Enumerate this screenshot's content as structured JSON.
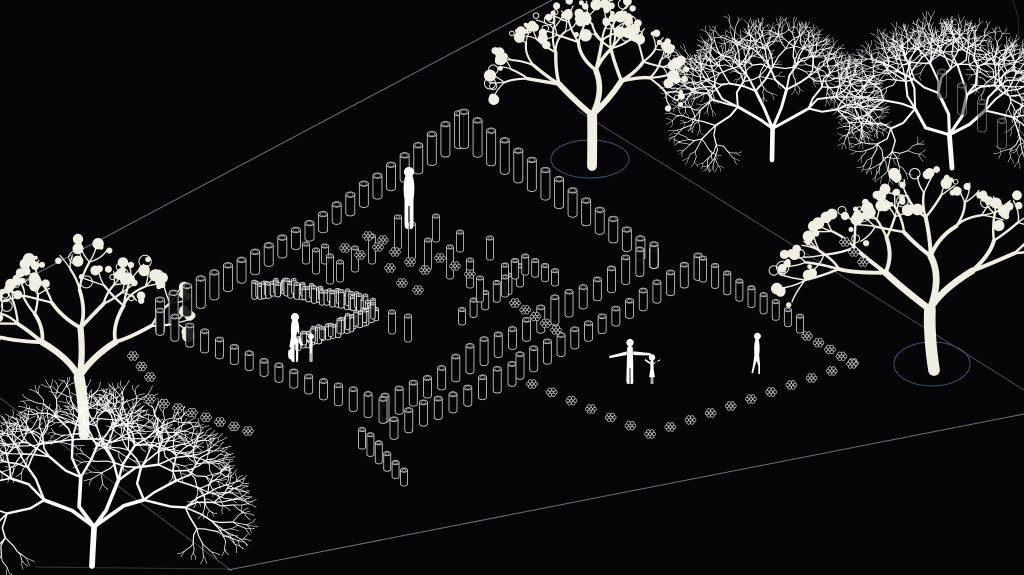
{
  "canvas": {
    "w": 1024,
    "h": 575,
    "background": "#050507"
  },
  "palette": {
    "line": "#9aa0b2",
    "post": "#c9c9cd",
    "post_bright": "#efefef",
    "hex": "#d6d6da",
    "person": "#ffffff",
    "fruit_tree": "#f0efe1",
    "bare_tree": "#fbfbfb",
    "pit": "#4a5580",
    "fill": "#050507"
  },
  "boundary_lines": [
    {
      "x1": 0,
      "y1": 293,
      "x2": 552,
      "y2": 0,
      "o": 0.7
    },
    {
      "x1": 577,
      "y1": 110,
      "x2": 1024,
      "y2": 390,
      "o": 0.45
    },
    {
      "x1": 228,
      "y1": 570,
      "x2": 1024,
      "y2": 414,
      "o": 0.7
    },
    {
      "x1": 0,
      "y1": 398,
      "x2": 232,
      "y2": 571,
      "o": 0.45
    },
    {
      "x1": 35,
      "y1": 567,
      "x2": 230,
      "y2": 569,
      "o": 0.3
    }
  ],
  "corner_arc": {
    "d": "M1012,0 Q1023,22 1016,46",
    "o": 0.25
  },
  "tree_pits": [
    {
      "cx": 590,
      "cy": 159,
      "rx": 39,
      "ry": 19
    },
    {
      "cx": 932,
      "cy": 364,
      "rx": 38,
      "ry": 22
    }
  ],
  "trees": [
    {
      "type": "fruit",
      "x": 592,
      "y": 166,
      "h": 150,
      "spread": 1.0,
      "seed": 11
    },
    {
      "type": "bare",
      "x": 772,
      "y": 160,
      "h": 158,
      "spread": 1.0,
      "seed": 42
    },
    {
      "type": "bare",
      "x": 952,
      "y": 168,
      "h": 166,
      "spread": 1.0,
      "seed": 53
    },
    {
      "type": "fruit",
      "x": 934,
      "y": 370,
      "h": 178,
      "spread": 1.15,
      "seed": 23
    },
    {
      "type": "fruit",
      "x": 84,
      "y": 434,
      "h": 166,
      "spread": 1.05,
      "seed": 35
    },
    {
      "type": "bare",
      "x": 92,
      "y": 566,
      "h": 196,
      "spread": 1.15,
      "seed": 64
    }
  ],
  "post_rows": [
    {
      "name": "left-nw-edge",
      "pts": [
        [
          160,
          331
        ],
        [
          459,
          146
        ]
      ],
      "n": 23,
      "w": 9,
      "h": 15,
      "amp": 16,
      "pat": "ends"
    },
    {
      "name": "left-ne-edge",
      "pts": [
        [
          464,
          146
        ],
        [
          654,
          266
        ]
      ],
      "n": 15,
      "w": 9,
      "h": 16,
      "amp": 18,
      "pat": "desc"
    },
    {
      "name": "left-se-edge",
      "pts": [
        [
          654,
          266
        ],
        [
          385,
          420
        ]
      ],
      "n": 20,
      "w": 8,
      "h": 17,
      "amp": 7,
      "pat": "wave"
    },
    {
      "name": "left-sw-edge",
      "pts": [
        [
          160,
          333
        ],
        [
          383,
          421
        ]
      ],
      "n": 16,
      "w": 8,
      "h": 13,
      "amp": 9,
      "pat": "ends"
    },
    {
      "name": "hook-row",
      "pts": [
        [
          362,
          447
        ],
        [
          404,
          484
        ]
      ],
      "n": 6,
      "w": 7,
      "h": 13,
      "amp": 5,
      "pat": "wave"
    },
    {
      "name": "entry-row",
      "pts": [
        [
          394,
          437
        ],
        [
          512,
          384
        ]
      ],
      "n": 9,
      "w": 8,
      "h": 15,
      "amp": 5,
      "pat": "wave"
    },
    {
      "name": "mid-row-a",
      "pts": [
        [
          462,
          323
        ],
        [
          520,
          285
        ]
      ],
      "n": 6,
      "w": 7,
      "h": 13,
      "amp": 5,
      "pat": "asc"
    },
    {
      "name": "mid-row-b",
      "pts": [
        [
          505,
          281
        ],
        [
          528,
          272
        ],
        [
          555,
          284
        ]
      ],
      "n": 6,
      "w": 7,
      "h": 12,
      "amp": 4,
      "pat": "wave"
    },
    {
      "name": "right-nw-edge",
      "pts": [
        [
          520,
          377
        ],
        [
          698,
          278
        ]
      ],
      "n": 14,
      "w": 8,
      "h": 14,
      "amp": 8,
      "pat": "ends"
    },
    {
      "name": "right-ne-edge",
      "pts": [
        [
          703,
          280
        ],
        [
          800,
          331
        ]
      ],
      "n": 9,
      "w": 7,
      "h": 14,
      "amp": 6,
      "pat": "desc"
    },
    {
      "name": "grove-row",
      "pts": [
        [
          942,
          96
        ],
        [
          1002,
          146
        ]
      ],
      "n": 4,
      "w": 9,
      "h": 22,
      "amp": 4,
      "pat": "wave",
      "o": 0.5
    }
  ],
  "dense_band": {
    "pts": [
      [
        256,
        299
      ],
      [
        282,
        293
      ],
      [
        308,
        299
      ],
      [
        364,
        311
      ],
      [
        375,
        319
      ],
      [
        330,
        338
      ],
      [
        298,
        348
      ]
    ],
    "n": 46,
    "w": 5.5,
    "h": 10
  },
  "hex_rows": [
    {
      "pts": [
        [
          807,
          336
        ],
        [
          853,
          363
        ]
      ],
      "n": 5
    },
    {
      "pts": [
        [
          532,
          384
        ],
        [
          650,
          434
        ],
        [
          852,
          364
        ]
      ],
      "n": 17
    },
    {
      "pts": [
        [
          150,
          399
        ],
        [
          248,
          431
        ]
      ],
      "n": 8
    },
    {
      "pts": [
        [
          515,
          303
        ],
        [
          556,
          330
        ]
      ],
      "n": 5
    },
    {
      "pts": [
        [
          845,
          242
        ],
        [
          863,
          262
        ]
      ],
      "n": 3
    },
    {
      "pts": [
        [
          133,
          356
        ],
        [
          150,
          377
        ]
      ],
      "n": 3
    }
  ],
  "hex_scatter": [
    [
      345,
      248
    ],
    [
      360,
      255
    ],
    [
      378,
      247
    ],
    [
      395,
      252
    ],
    [
      390,
      268
    ],
    [
      410,
      262
    ],
    [
      425,
      270
    ],
    [
      440,
      258
    ],
    [
      455,
      266
    ],
    [
      470,
      274
    ],
    [
      402,
      283
    ],
    [
      418,
      290
    ],
    [
      383,
      240
    ],
    [
      368,
      236
    ]
  ],
  "post_scatter": [
    [
      398,
      247,
      30
    ],
    [
      412,
      258,
      34
    ],
    [
      428,
      268,
      28
    ],
    [
      372,
      262,
      26
    ],
    [
      355,
      270,
      22
    ],
    [
      450,
      277,
      30
    ],
    [
      470,
      286,
      26
    ],
    [
      490,
      258,
      20
    ],
    [
      340,
      280,
      18
    ],
    [
      325,
      262,
      16
    ],
    [
      505,
      295,
      18
    ],
    [
      480,
      300,
      22
    ],
    [
      392,
      332,
      20
    ],
    [
      408,
      340,
      24
    ],
    [
      316,
      272,
      22
    ],
    [
      330,
      282,
      26
    ],
    [
      306,
      262,
      18
    ],
    [
      436,
      240,
      24
    ],
    [
      460,
      250,
      18
    ]
  ],
  "people": [
    {
      "pose": "standing",
      "x": 409,
      "y": 229,
      "h": 64
    },
    {
      "pose": "adult-bag",
      "x": 295,
      "y": 362,
      "h": 51
    },
    {
      "pose": "child-hand",
      "x": 311,
      "y": 362,
      "h": 30
    },
    {
      "pose": "arms-out",
      "x": 630,
      "y": 384,
      "h": 46
    },
    {
      "pose": "arms-out-child",
      "x": 652,
      "y": 384,
      "h": 32
    },
    {
      "pose": "walking",
      "x": 757,
      "y": 374,
      "h": 43
    }
  ]
}
